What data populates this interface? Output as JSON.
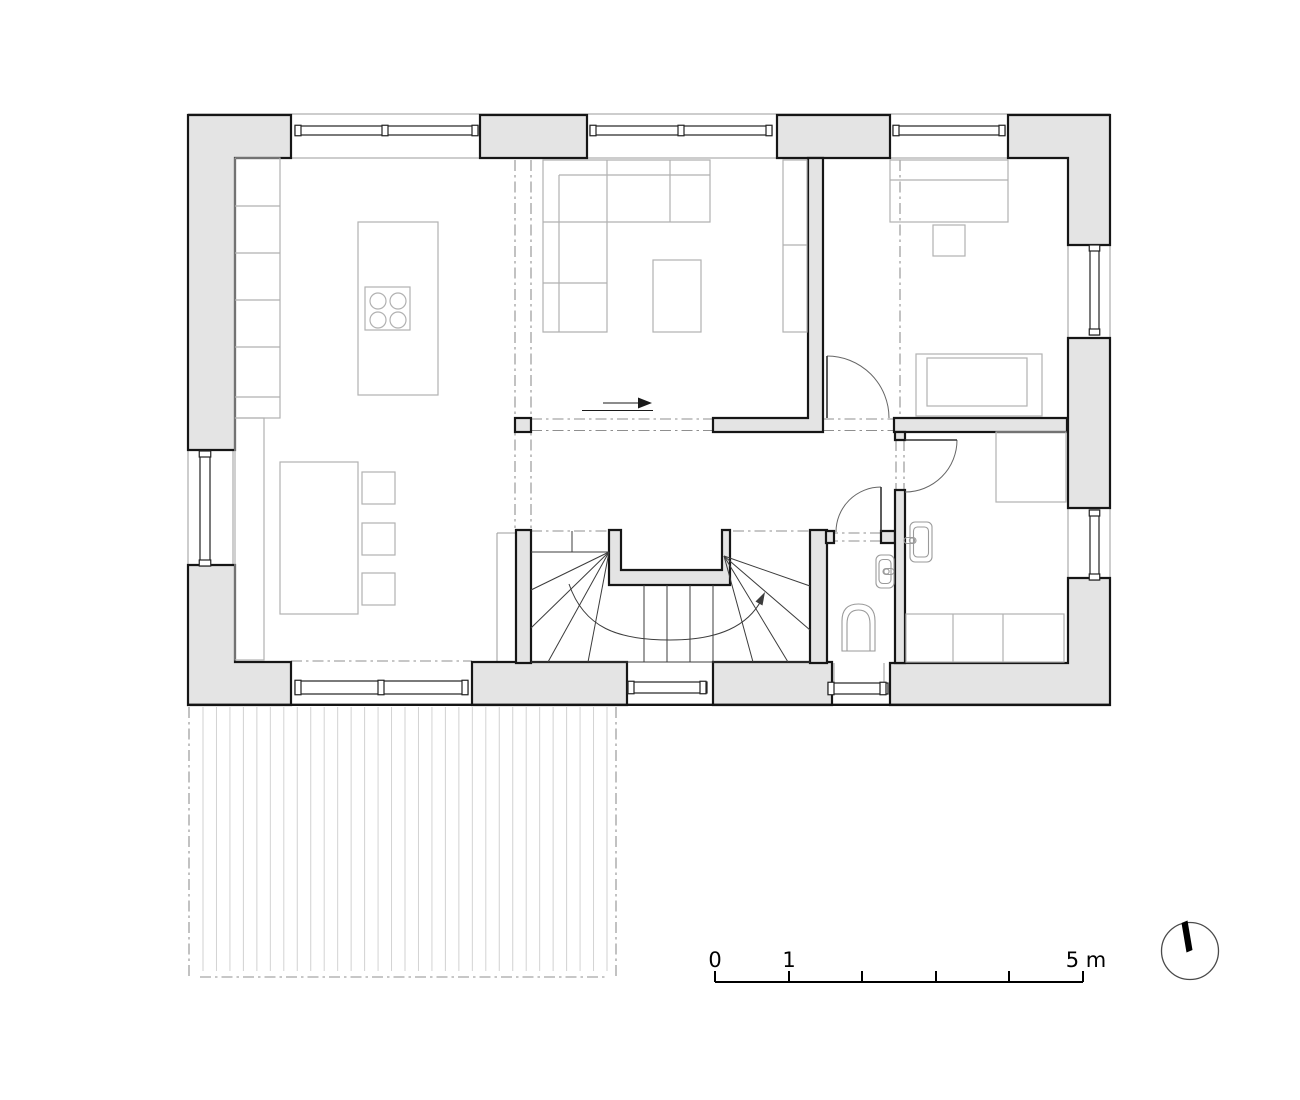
{
  "colors": {
    "background": "#ffffff",
    "wall_fill": "#e4e4e4",
    "wall_stroke": "#161616",
    "thin_line": "#9b9b9b",
    "furniture": "#b1b1b1",
    "fixture": "#9a9a9a",
    "dashdot": "#8f8f8f",
    "deck_board": "#d2d2d2",
    "stair_line": "#3c3c3c",
    "door_leaf": "#333333",
    "door_arc": "#666666"
  },
  "scale_bar": {
    "unit_labels": [
      {
        "text": "0",
        "x": 715
      },
      {
        "text": "1",
        "x": 789
      },
      {
        "text": "5 m",
        "x": 1086
      }
    ],
    "baseline": {
      "x1": 715,
      "y": 982,
      "x2": 1083
    },
    "ticks": [
      715,
      789,
      862,
      936,
      1009,
      1083
    ],
    "tick_top": 971,
    "label_top": 948
  },
  "north_arrow": {
    "cx": 1190,
    "cy": 951,
    "r": 28.5,
    "needle": "1181.5,923 1187.5,920.5 1192.5,950 1186.5,952.5"
  },
  "plan": {
    "exterior_walls": [
      {
        "name": "pier-top-left",
        "pts": "188,115 291,115 291,158 235,158 235,450 188,450"
      },
      {
        "name": "pier-top-mid",
        "pts": "480,115 587,115 587,158 480,158"
      },
      {
        "name": "pier-top-right-mid",
        "pts": "777,115 890,115 890,158 777,158"
      },
      {
        "name": "pier-top-right",
        "pts": "1008,115 1110,115 1110,245 1068,245 1068,158 1008,158"
      },
      {
        "name": "pier-right-mid",
        "pts": "1068,338 1110,338 1110,508 1068,508"
      },
      {
        "name": "pier-bottom-right",
        "pts": "890,663 1068,663 1068,578 1110,578 1110,705 890,705"
      },
      {
        "name": "pier-bottom-mid-left",
        "pts": "472,662 627,662 627,705 472,705"
      },
      {
        "name": "pier-bottom-mid-right",
        "pts": "713,662 832,662 832,705 713,705"
      },
      {
        "name": "pier-bottom-left",
        "pts": "188,565 235,565 235,662 291,662 291,705 188,705"
      }
    ],
    "interior_walls": [
      {
        "name": "wall-living-hall",
        "pts": "808,158 823,158 823,432 713,432 713,418 808,418"
      },
      {
        "name": "wall-bedroom-south",
        "pts": "894,418 1067,418 1067,432 894,432"
      },
      {
        "name": "wall-stair-west",
        "pts": "516,530 531,530 531,663 516,663"
      },
      {
        "name": "wall-stair-east",
        "pts": "810,530 827,530 827,663 810,663"
      },
      {
        "name": "wall-stair-core",
        "pts": "609,530 621,530 621,570 722,570 722,530 730,530 730,585 609,585"
      },
      {
        "name": "wall-wc-north-a",
        "pts": "826,531 834,531 834,543 826,543"
      },
      {
        "name": "wall-wc-north-b",
        "pts": "881,531 895,531 895,543 881,543"
      },
      {
        "name": "wall-bath-west-stub",
        "pts": "895,432 905,432 905,440 895,440"
      },
      {
        "name": "wall-bath-west",
        "pts": "895,490 905,490 905,663 895,663"
      }
    ],
    "column": {
      "x": 515,
      "y": 418,
      "w": 16,
      "h": 14
    },
    "windows": [
      {
        "name": "window-top-1",
        "dir": "h",
        "x": 295,
        "y": 126,
        "w": 183,
        "h": 9,
        "mullions": [
          295,
          382,
          472
        ]
      },
      {
        "name": "window-top-2",
        "dir": "h",
        "x": 590,
        "y": 126,
        "w": 182,
        "h": 9,
        "mullions": [
          590,
          678,
          766
        ]
      },
      {
        "name": "window-top-3",
        "dir": "h",
        "x": 893,
        "y": 126,
        "w": 112,
        "h": 9,
        "mullions": [
          893,
          999
        ]
      },
      {
        "name": "window-left",
        "dir": "v",
        "x": 200,
        "y": 451,
        "w": 10,
        "h": 115,
        "mullions": [
          451,
          560
        ]
      },
      {
        "name": "window-right-1",
        "dir": "v",
        "x": 1090,
        "y": 245,
        "w": 9,
        "h": 90,
        "mullions": [
          245,
          329
        ]
      },
      {
        "name": "window-right-2",
        "dir": "v",
        "x": 1090,
        "y": 510,
        "w": 9,
        "h": 70,
        "mullions": [
          510,
          574
        ]
      },
      {
        "name": "window-bottom-1",
        "dir": "h",
        "x": 295,
        "y": 681,
        "w": 173,
        "h": 13,
        "mullions": [
          295,
          378,
          462
        ]
      },
      {
        "name": "window-bottom-2",
        "dir": "h",
        "x": 628,
        "y": 682,
        "w": 79,
        "h": 11,
        "mullions": [
          628,
          700
        ]
      },
      {
        "name": "window-bottom-3",
        "dir": "h",
        "x": 828,
        "y": 683,
        "w": 60,
        "h": 11,
        "mullions": [
          828,
          880
        ]
      }
    ],
    "thin_lines": [
      [
        188,
        114,
        1110,
        114
      ],
      [
        291,
        158,
        480,
        158
      ],
      [
        587,
        158,
        777,
        158
      ],
      [
        890,
        158,
        1008,
        158
      ],
      [
        188,
        450,
        188,
        566
      ],
      [
        233,
        450,
        233,
        566
      ],
      [
        1110,
        245,
        1110,
        338
      ],
      [
        1110,
        508,
        1110,
        578
      ],
      [
        1068,
        245,
        1068,
        338
      ],
      [
        1068,
        508,
        1068,
        578
      ],
      [
        497,
        533,
        497,
        662
      ],
      [
        497,
        533,
        516,
        533
      ],
      [
        834,
        663,
        834,
        683
      ],
      [
        884,
        663,
        884,
        683
      ]
    ],
    "thick_lines": [
      [
        188,
        704.8,
        1110,
        704.8
      ]
    ],
    "dashdot_lines": [
      [
        515,
        160,
        515,
        528
      ],
      [
        531,
        160,
        531,
        528
      ],
      [
        900,
        160,
        900,
        418
      ],
      [
        531,
        419,
        713,
        419
      ],
      [
        531,
        430.5,
        713,
        430.5
      ],
      [
        823,
        419,
        894,
        419
      ],
      [
        823,
        430.5,
        894,
        430.5
      ],
      [
        827,
        533,
        895,
        533
      ],
      [
        827,
        541,
        895,
        541
      ],
      [
        896,
        440,
        896,
        490
      ],
      [
        904,
        440,
        904,
        490
      ],
      [
        733,
        531,
        810,
        531
      ],
      [
        531,
        531,
        609,
        531
      ],
      [
        291,
        661,
        472,
        661
      ],
      [
        189,
        707,
        189,
        977
      ],
      [
        616,
        707,
        616,
        977
      ],
      [
        200,
        977,
        605,
        977
      ]
    ],
    "terrace": {
      "boards": {
        "x0": 203,
        "x1": 607,
        "count": 31,
        "y0": 707,
        "y1": 971
      },
      "posts": [
        {
          "x": 188.5,
          "y": 970,
          "w": 11.5,
          "h": 13
        },
        {
          "x": 604.5,
          "y": 970,
          "w": 11.5,
          "h": 13
        }
      ]
    },
    "furniture": {
      "rects": [
        {
          "name": "kitchen-counter",
          "x": 235,
          "y": 158,
          "w": 45,
          "h": 260
        },
        {
          "name": "kitchen-sideboard",
          "x": 235,
          "y": 418,
          "w": 29,
          "h": 242
        },
        {
          "name": "kitchen-island",
          "x": 358,
          "y": 222,
          "w": 80,
          "h": 173
        },
        {
          "name": "cooktop",
          "x": 365,
          "y": 287,
          "w": 45,
          "h": 43
        },
        {
          "name": "dining-table",
          "x": 280,
          "y": 462,
          "w": 78,
          "h": 152
        },
        {
          "name": "chair",
          "x": 362,
          "y": 472,
          "w": 33,
          "h": 32
        },
        {
          "name": "chair",
          "x": 362,
          "y": 523,
          "w": 33,
          "h": 32
        },
        {
          "name": "chair",
          "x": 362,
          "y": 573,
          "w": 33,
          "h": 32
        },
        {
          "name": "coffee-table",
          "x": 653,
          "y": 260,
          "w": 48,
          "h": 72
        },
        {
          "name": "tv-unit",
          "x": 783,
          "y": 160,
          "w": 24,
          "h": 172
        },
        {
          "name": "wardrobe",
          "x": 890,
          "y": 160,
          "w": 118,
          "h": 62
        },
        {
          "name": "nightstand",
          "x": 933,
          "y": 225,
          "w": 32,
          "h": 31
        },
        {
          "name": "bed",
          "x": 916,
          "y": 354,
          "w": 126,
          "h": 62
        },
        {
          "name": "bed-mattress",
          "x": 927,
          "y": 358,
          "w": 100,
          "h": 48
        },
        {
          "name": "shower",
          "x": 996,
          "y": 432,
          "w": 70,
          "h": 70
        },
        {
          "name": "bathroom-bench",
          "x": 906,
          "y": 614,
          "w": 158,
          "h": 48
        }
      ],
      "lines": [
        [
          235,
          206,
          280,
          206
        ],
        [
          235,
          253,
          280,
          253
        ],
        [
          235,
          300,
          280,
          300
        ],
        [
          235,
          347,
          280,
          347
        ],
        [
          235,
          397,
          280,
          397
        ],
        [
          783,
          245,
          807,
          245
        ],
        [
          890,
          180,
          1008,
          180
        ],
        [
          953,
          614,
          953,
          662
        ],
        [
          1003,
          614,
          1003,
          662
        ],
        [
          559,
          175,
          710,
          175
        ],
        [
          559,
          175,
          559,
          332
        ],
        [
          543,
          222,
          607,
          222
        ],
        [
          543,
          283,
          607,
          283
        ],
        [
          670,
          160,
          670,
          222
        ],
        [
          607,
          160,
          607,
          222
        ]
      ],
      "circles": [
        {
          "name": "burner",
          "cx": 378,
          "cy": 301,
          "r": 8
        },
        {
          "name": "burner",
          "cx": 398,
          "cy": 301,
          "r": 8
        },
        {
          "name": "burner",
          "cx": 378,
          "cy": 320,
          "r": 8
        },
        {
          "name": "burner",
          "cx": 398,
          "cy": 320,
          "r": 8
        }
      ],
      "paths": [
        {
          "name": "sofa",
          "d": "M543,160 L710,160 L710,222 L607,222 L607,332 L543,332 Z"
        }
      ]
    },
    "fixtures": {
      "rects": [
        {
          "name": "washbasin",
          "x": 910,
          "y": 522,
          "w": 22,
          "h": 40,
          "rx": 5
        },
        {
          "name": "washbasin-inner",
          "x": 913.5,
          "y": 527,
          "w": 15,
          "h": 30,
          "rx": 4
        },
        {
          "name": "washbasin",
          "x": 876,
          "y": 555,
          "w": 18,
          "h": 33,
          "rx": 5
        },
        {
          "name": "washbasin-inner",
          "x": 879,
          "y": 559.5,
          "w": 12,
          "h": 24,
          "rx": 4
        },
        {
          "name": "faucet",
          "x": 904,
          "y": 537.5,
          "w": 12,
          "h": 6,
          "rx": 3
        },
        {
          "name": "faucet",
          "x": 883,
          "y": 568.5,
          "w": 11,
          "h": 6,
          "rx": 3
        }
      ],
      "circles": [
        {
          "name": "faucet-knob",
          "cx": 912,
          "cy": 540.5,
          "r": 2.6
        },
        {
          "name": "faucet-knob",
          "cx": 886.5,
          "cy": 571.5,
          "r": 2.6
        }
      ],
      "paths": [
        {
          "name": "toilet",
          "d": "M842,651 L842,621 Q842,604 858.5,604 Q875,604 875,621 L875,651 Z"
        },
        {
          "name": "toilet-bowl",
          "d": "M847,651 L847,624 Q847,610 858.5,610 Q870,610 870,624 L870,651"
        }
      ]
    },
    "stairs": {
      "treads_x": [
        644,
        667,
        690,
        713
      ],
      "treads_y1": 585,
      "treads_y2": 662,
      "lines": [
        [
          531,
          552,
          609,
          552
        ],
        [
          572,
          531,
          572,
          552
        ],
        [
          609,
          552,
          531,
          590
        ],
        [
          609,
          552,
          531,
          628
        ],
        [
          609,
          552,
          548,
          662
        ],
        [
          609,
          552,
          588,
          662
        ],
        [
          724,
          556,
          810,
          586
        ],
        [
          724,
          556,
          810,
          630
        ],
        [
          724,
          556,
          788,
          662
        ],
        [
          724,
          556,
          753,
          662
        ],
        [
          531,
          662,
          810,
          662
        ]
      ],
      "walk_line": "M569,584 C584,628 618,640 670,640 C719,640 748,626 762,599",
      "arrow_head": "765,592 762.5,605.5 755.5,601.5"
    },
    "doors": [
      {
        "name": "door-bedroom",
        "leaf": [
          827,
          356,
          827,
          418
        ],
        "arc": "M827,356 A62,62 0 0 1 889,418"
      },
      {
        "name": "door-wc",
        "leaf": [
          881,
          487,
          881,
          532
        ],
        "arc": "M881,487 A45,45 0 0 0 836,532"
      },
      {
        "name": "door-bathroom",
        "leaf": [
          905,
          440,
          957,
          440
        ],
        "arc": "M957,440 A52,52 0 0 1 905,492"
      }
    ],
    "direction_arrow": {
      "shaft": [
        603,
        403,
        645,
        403
      ],
      "head": "652,403 638,397.5 638,408.5",
      "underline": [
        582,
        410.5,
        653,
        410.5
      ]
    }
  }
}
